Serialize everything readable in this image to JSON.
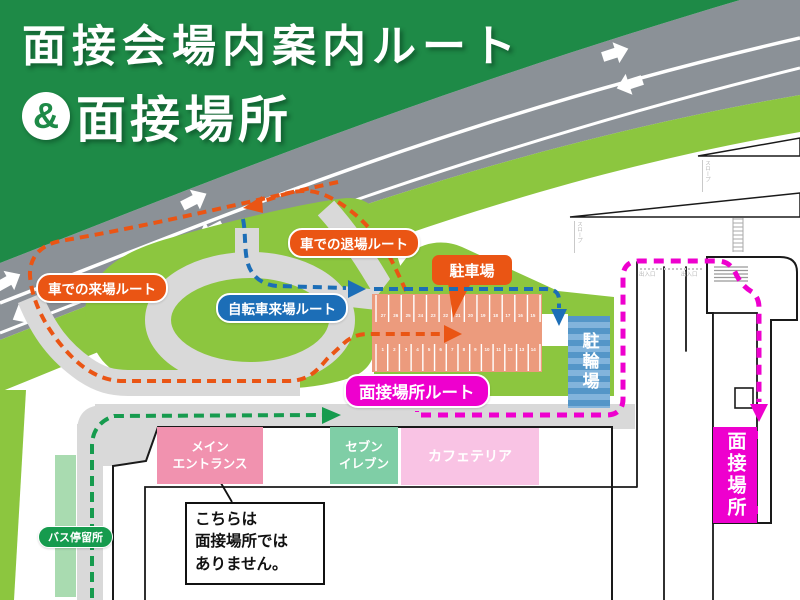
{
  "title": {
    "line1": "面接会場内案内ルート",
    "amp": "&",
    "line2": "面接場所"
  },
  "routes": {
    "car_arrival": {
      "label": "車での来場ルート"
    },
    "car_exit": {
      "label": "車での退場ルート"
    },
    "bicycle": {
      "label": "自転車来場ルート"
    },
    "interview": {
      "label": "面接場所ルート"
    }
  },
  "places": {
    "parking": {
      "label": "駐車場",
      "stalls_top": [
        "27",
        "26",
        "25",
        "24",
        "23",
        "22",
        "21",
        "20",
        "19",
        "18",
        "17",
        "16",
        "15"
      ],
      "stalls_bottom": [
        "1",
        "2",
        "3",
        "4",
        "5",
        "6",
        "7",
        "8",
        "9",
        "10",
        "11",
        "12",
        "13",
        "14"
      ]
    },
    "bicycle_parking": {
      "label": "駐輪場"
    },
    "interview_place": {
      "label": "面接場所"
    },
    "bus_stop": {
      "label": "バス停留所"
    },
    "main_entrance": {
      "line1": "メイン",
      "line2": "エントランス"
    },
    "seven_eleven": {
      "line1": "セブン",
      "line2": "イレブン"
    },
    "cafeteria": {
      "label": "カフェテリア"
    }
  },
  "callout": {
    "line1": "こちらは",
    "line2": "面接場所では",
    "line3": "ありません。"
  },
  "annotations": {
    "slope_upper": "スロープ",
    "slope_lower": "スロープ",
    "door_left": "出入口",
    "door_right": "出入口"
  },
  "colors": {
    "header-green": "#1E8A47",
    "map-green": "#8CC63F",
    "pale-green": "#A9DBB0",
    "road-gray": "#8B9197",
    "path-gray": "#D9D9D9",
    "orange": "#EA5514",
    "blue": "#1C6EB7",
    "magenta": "#EE00CE",
    "route-green": "#169B4E",
    "salmon": "#EC9B7D",
    "bike-blue": "#5496C8",
    "bike-blue-light": "#82B4DC",
    "mint": "#7FCEA6",
    "pink": "#F192AF",
    "pale-pink": "#F9C3E4",
    "line-black": "#1A1A1A"
  }
}
